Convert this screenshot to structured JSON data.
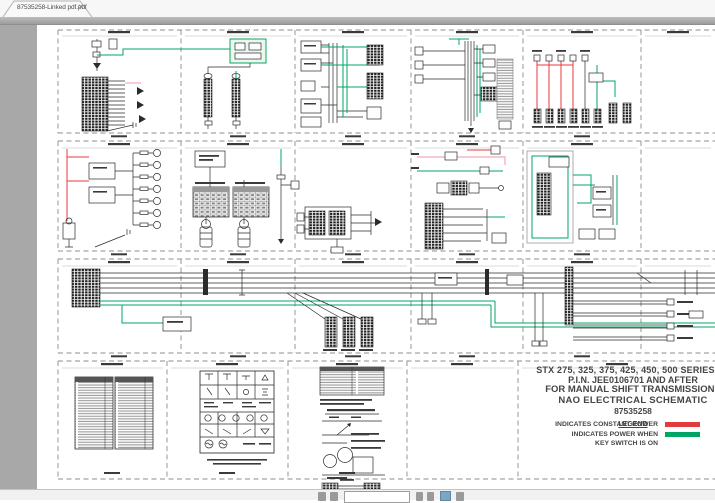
{
  "tab_bar": {
    "title": "87535258-Linked pdf.pdf",
    "close_icon": "✕"
  },
  "document": {
    "title_block": {
      "line1": "STX 275, 325, 375, 425, 450, 500 SERIES TR",
      "line2": "P.I.N. JEE0106701 AND AFTER",
      "line3": "FOR MANUAL SHIFT TRANSMISSIONS",
      "line4": "NAO ELECTRICAL SCHEMATIC",
      "line5": "87535258",
      "legend_title": "LEGEND",
      "legend": [
        {
          "label": "INDICATES CONSTANT POWER",
          "color": "#e23b3e"
        },
        {
          "label": "INDICATES POWER WHEN",
          "label2": "KEY SWITCH IS ON",
          "color": "#00a566"
        }
      ]
    },
    "schematic_colors": {
      "constant_power_red": "#e23b3e",
      "key_on_green": "#00a566",
      "wire_black": "#2b2b2b",
      "wire_pink": "#f2a9b4"
    }
  }
}
